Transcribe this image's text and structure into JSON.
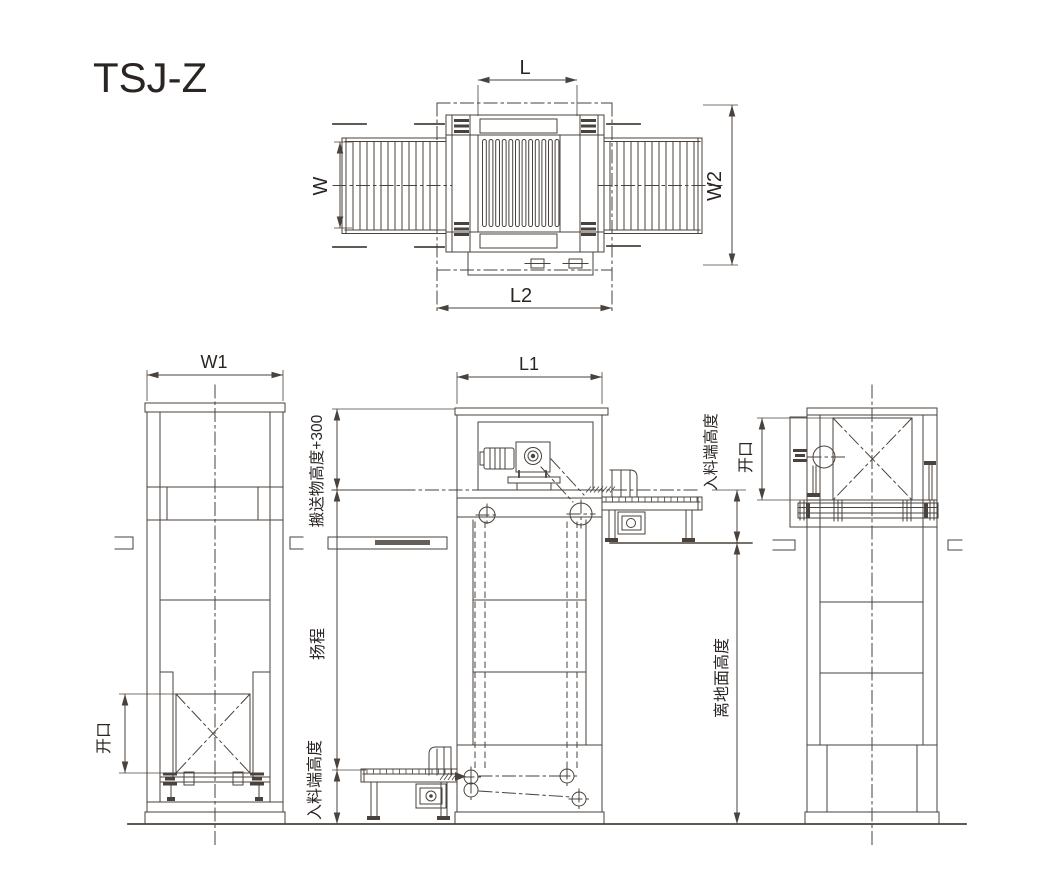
{
  "drawing": {
    "title": "TSJ-Z",
    "dimensions": {
      "top_view": {
        "length_top": "L",
        "width_rollers": "W",
        "width_overall": "W2",
        "length_frame": "L2"
      },
      "left_view": {
        "width": "W1",
        "opening": "开口"
      },
      "front_view": {
        "length": "L1",
        "carry_clearance": "搬送物高度+300",
        "lift_stroke": "扬程",
        "infeed_height": "入料端高度"
      },
      "right_view": {
        "infeed_height": "入料端高度",
        "opening": "开口",
        "floor_height": "离地面高度"
      }
    }
  }
}
